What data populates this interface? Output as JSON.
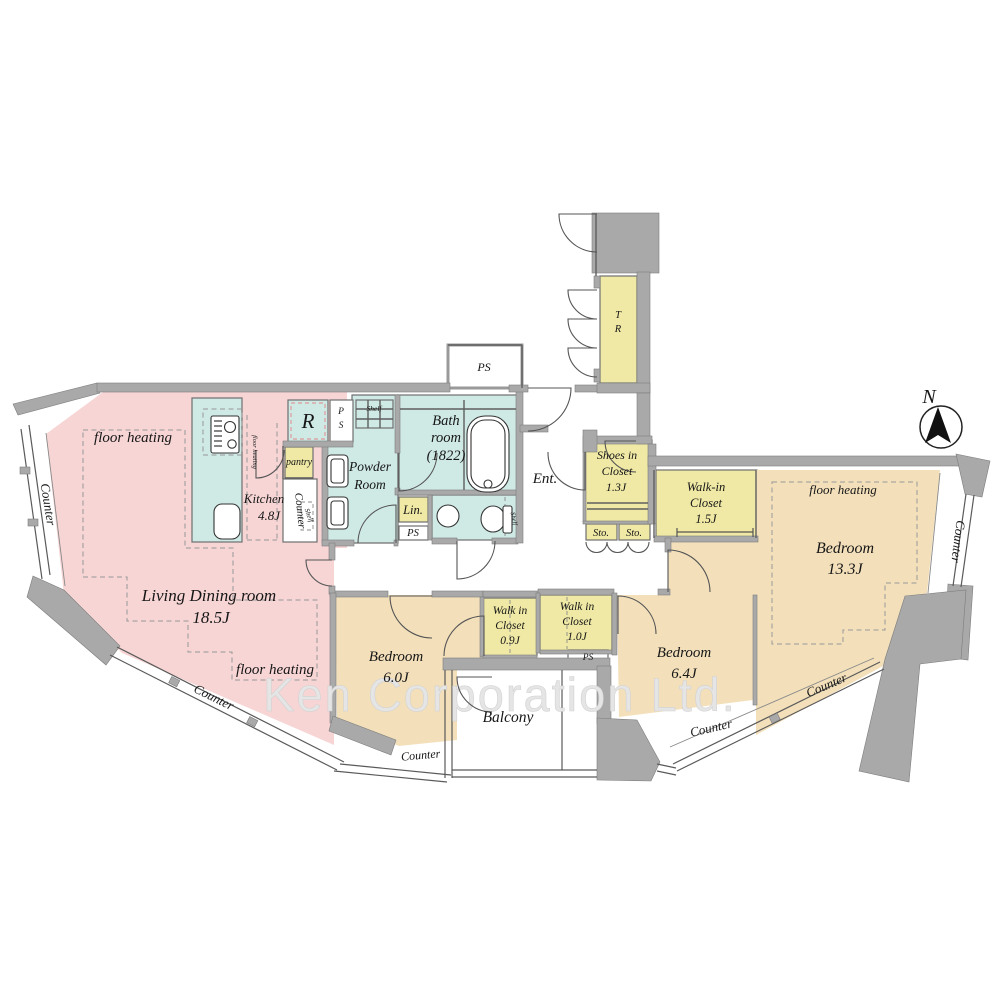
{
  "watermark": "Ken Corporation Ltd.",
  "compass": {
    "north": "N"
  },
  "colors": {
    "living_pink": "#f7d5d5",
    "wet_cyan": "#cfe9e5",
    "closet_yellow": "#f0e9a5",
    "bedroom_tan": "#f3e0bb",
    "wall_gray": "#a9a9a9",
    "watermark_gray": "#e5e5e5",
    "text_black": "#161616"
  },
  "rooms": {
    "living": {
      "name": "Living Dining room",
      "size": "18.5J"
    },
    "kitchen": {
      "name": "Kitchen",
      "size": "4.8J"
    },
    "powder": {
      "l1": "Powder",
      "l2": "Room"
    },
    "bath": {
      "l1": "Bath",
      "l2": "room",
      "l3": "(1822)"
    },
    "bedroom13": {
      "name": "Bedroom",
      "size": "13.3J"
    },
    "bedroom60": {
      "name": "Bedroom",
      "size": "6.0J"
    },
    "bedroom64": {
      "name": "Bedroom",
      "size": "6.4J"
    },
    "wic15": {
      "l1": "Walk-in",
      "l2": "Closet",
      "size": "1.5J"
    },
    "wic09": {
      "l1": "Walk in",
      "l2": "Closet",
      "size": "0.9J"
    },
    "wic10": {
      "l1": "Walk in",
      "l2": "Closet",
      "size": "1.0J"
    },
    "shoes": {
      "l1": "Shoes in",
      "l2": "Closet",
      "size": "1.3J"
    },
    "balcony": {
      "name": "Balcony"
    },
    "entrance": {
      "name": "Ent."
    },
    "trunk": {
      "l1": "T",
      "l2": "R"
    },
    "linen": {
      "name": "Lin."
    },
    "pantry": {
      "name": "pantry"
    },
    "fridge": {
      "name": "R"
    }
  },
  "labels": {
    "floor_heating": "floor heating",
    "counter": "Counter",
    "shelf": "Shelf",
    "ps": "PS",
    "p": "P",
    "s": "S",
    "sto": "Sto."
  }
}
